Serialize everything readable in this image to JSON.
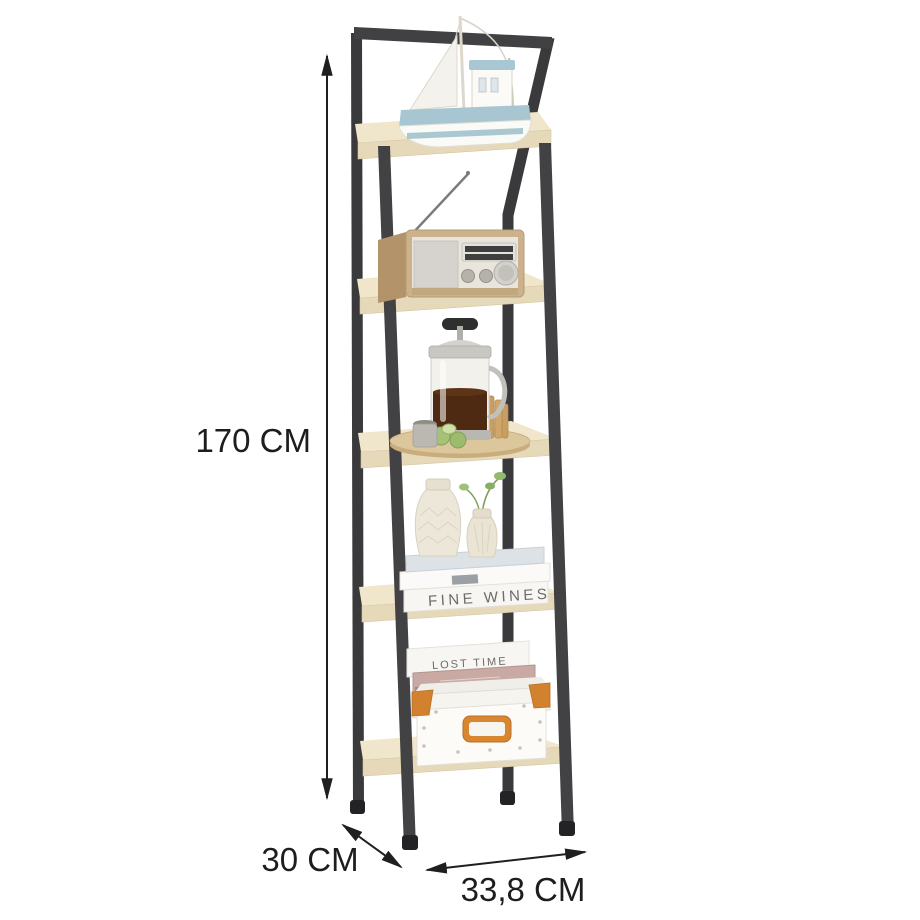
{
  "labels": {
    "height": "170 CM",
    "depth": "30 CM",
    "width": "33,8 CM"
  },
  "books": {
    "shelf4_spine": "FINE WINES",
    "shelf5_spine": "LOST TIME"
  },
  "product": {
    "type": "5-tier ladder bookshelf",
    "frame_color": "#3e3e40",
    "shelf_color": "#e6d9ba",
    "accent_color": "#d2822f",
    "shelves": [
      {
        "position": 1,
        "item": "model sailboat"
      },
      {
        "position": 2,
        "item": "vintage radio with antenna"
      },
      {
        "position": 3,
        "item": "french press on wooden board with crackers and limes"
      },
      {
        "position": 4,
        "item": "two cream vases on stack of books"
      },
      {
        "position": 5,
        "item": "white storage box with books on top"
      }
    ]
  }
}
